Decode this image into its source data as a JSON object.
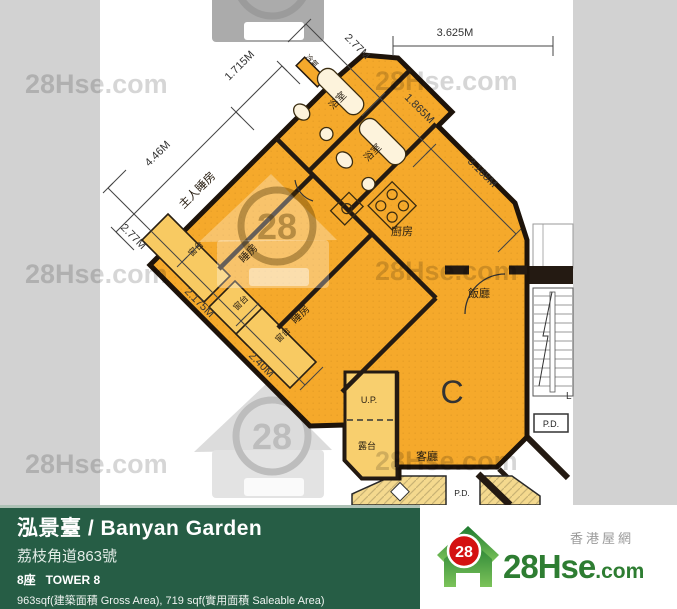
{
  "watermark": {
    "site_text": "28Hse.com",
    "logo_number": "28"
  },
  "plan": {
    "unit_label": "C",
    "room_labels": {
      "master_bedroom": "主人睡房",
      "bedroom": "睡房",
      "bathroom": "浴室",
      "kitchen": "廚房",
      "dining_room": "飯廳",
      "living_room": "客廳",
      "balcony": "露台",
      "bay_window": "窗台",
      "utility_platform": "U.P.",
      "pipe_duct": "P.D.",
      "air_conditioner": "冷氣",
      "lift": "L"
    },
    "dimensions": {
      "upper_left_wing": "4.46M",
      "upper_left_bath": "1.715M",
      "upper_right_1": "2.77M",
      "upper_right_2": "1.865M",
      "upper_right_3": "3.168M",
      "top_horizontal": "3.625M",
      "lower_left_1": "2.77M",
      "lower_left_2": "2.175M",
      "lower_left_3": "2.40M"
    }
  },
  "footer": {
    "name": "泓景臺 / Banyan Garden",
    "address": "荔枝角道863號",
    "tower": "8座   TOWER 8",
    "area": "963sqf(建築面積 Gross Area), 719 sqf(實用面積 Saleable Area)"
  },
  "brand": {
    "site_part1": "28Hse",
    "site_part2": ".com",
    "tagline": "香港屋網",
    "logo_number": "28"
  }
}
